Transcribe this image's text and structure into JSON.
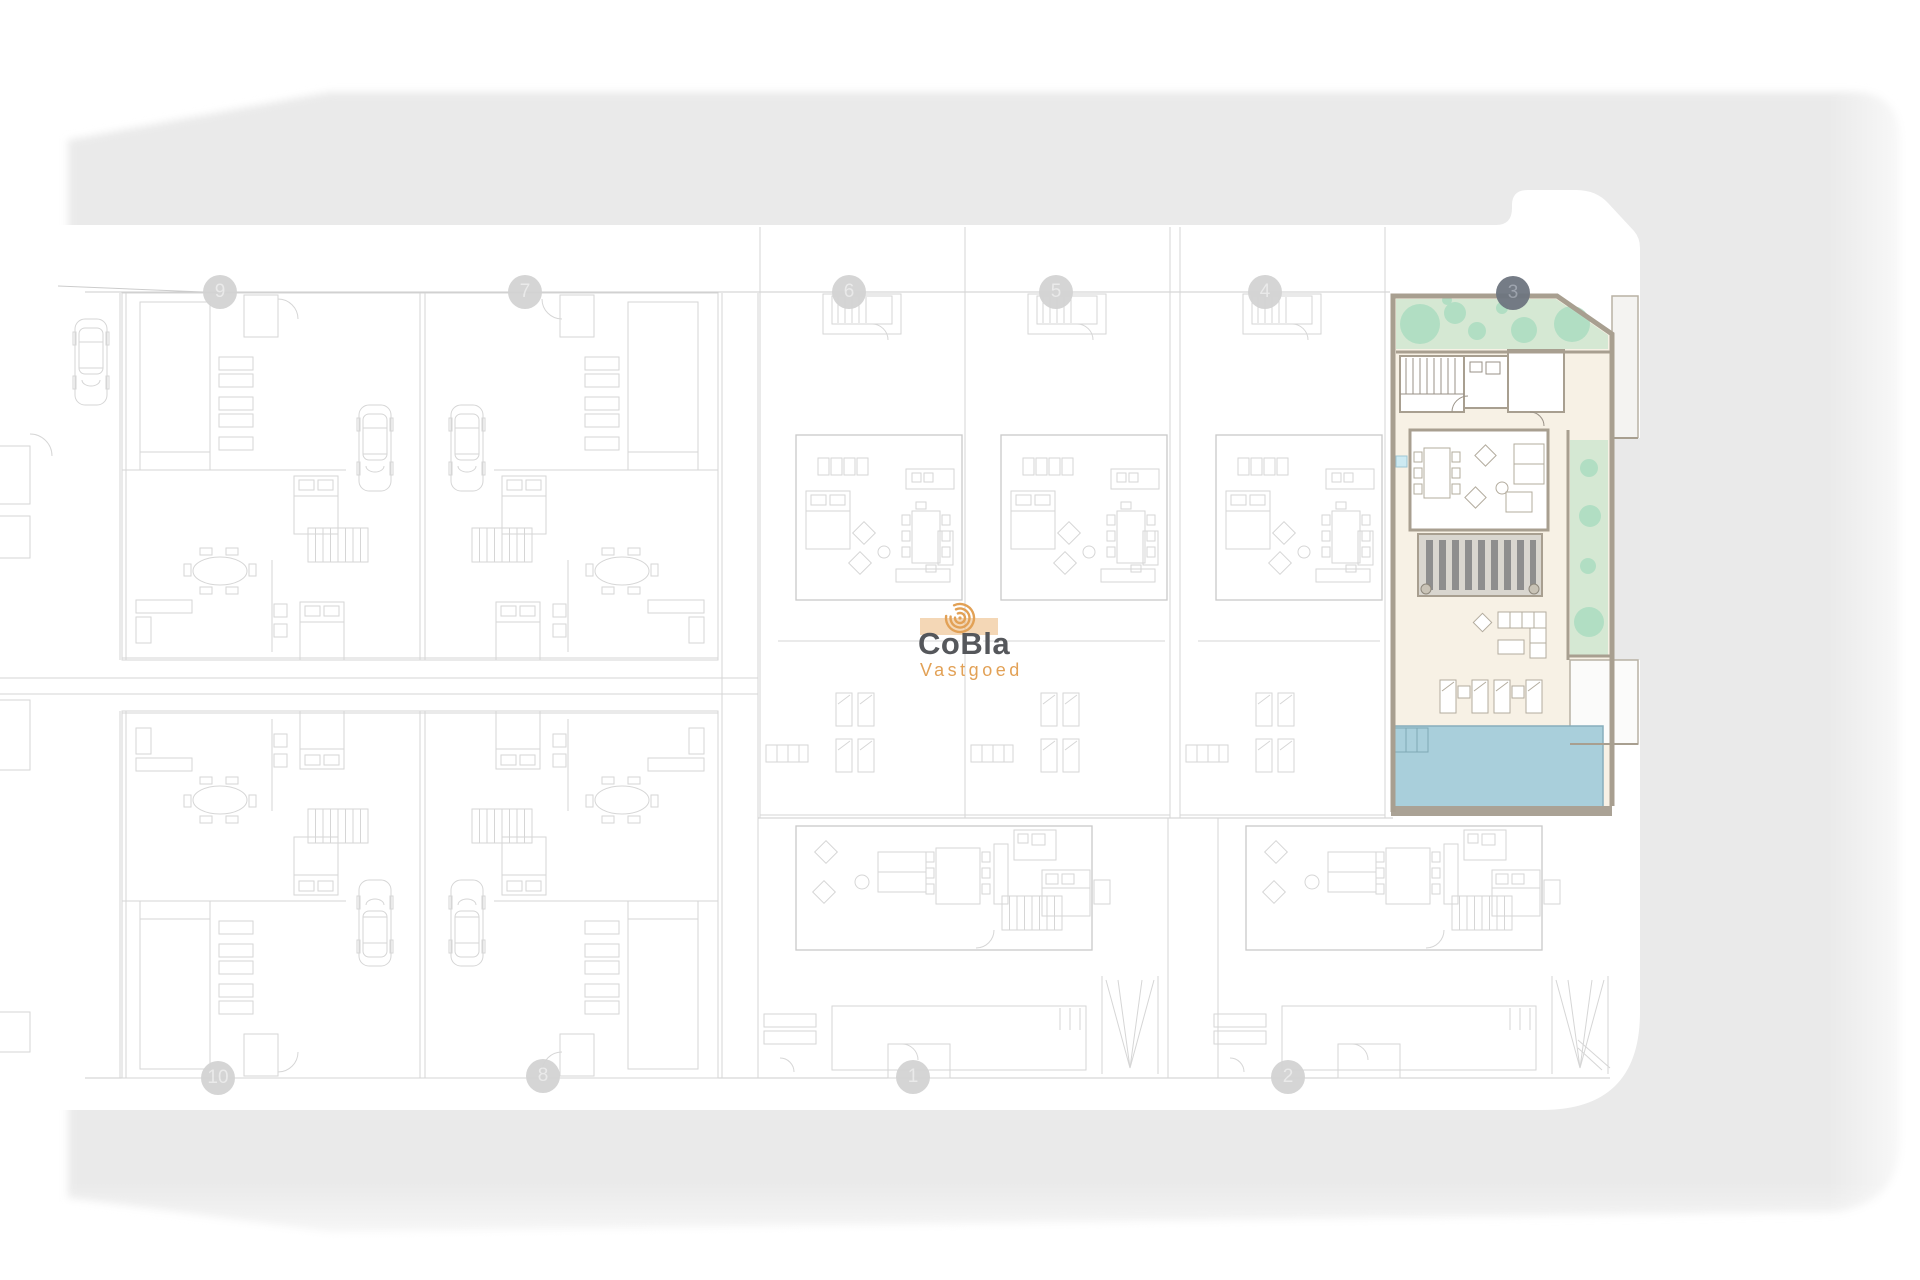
{
  "logo": {
    "brand": "CoBla",
    "tagline": "Vastgoed"
  },
  "selected_plot": {
    "number": "3"
  },
  "markers": {
    "top": [
      {
        "label": "9"
      },
      {
        "label": "7"
      },
      {
        "label": "6"
      },
      {
        "label": "5"
      },
      {
        "label": "4"
      },
      {
        "label": "3",
        "selected": true
      }
    ],
    "bottom": [
      {
        "label": "10"
      },
      {
        "label": "8"
      },
      {
        "label": "1"
      },
      {
        "label": "2"
      }
    ]
  },
  "colors": {
    "road_gray": "#eaeaea",
    "plan_line": "#d6d6d6",
    "plan_line_strong": "#c7c7c7",
    "wall_tan": "#a89f90",
    "garden_green": "#d5e8d3",
    "tree_green": "#a9dcc0",
    "interior_cream": "#f7f1e5",
    "pergola_base": "#d9d6cf",
    "pergola_slat": "#8e8e8e",
    "pool_blue": "#a9cfdb",
    "plunge_blue": "#cdeaf2",
    "brand_orange": "#e2a156",
    "brand_gray": "#55575b",
    "marker_gray": "#d3d3d3",
    "selected_marker_gray": "#6e7580"
  }
}
